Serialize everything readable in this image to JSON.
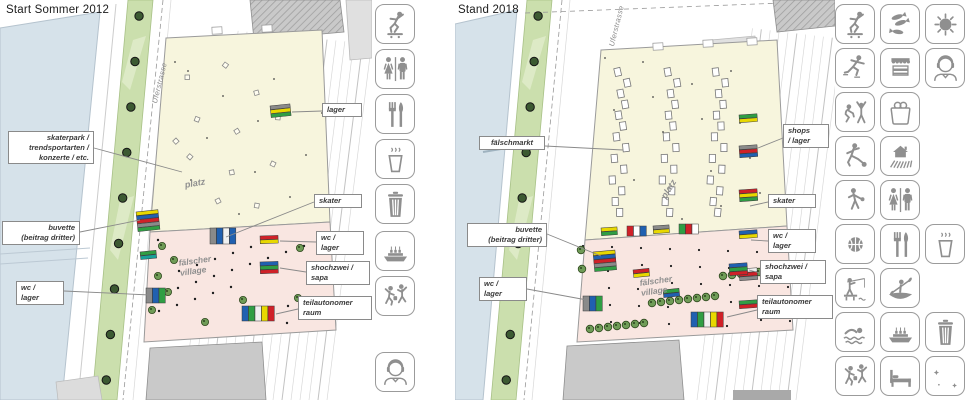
{
  "panel_2012": {
    "title": "Start Sommer 2012",
    "street_name": "Uferstrasse",
    "area_labels": {
      "platz": "platz",
      "village": "fälscher\nvillage"
    },
    "callouts": {
      "skaterpark": "skaterpark /\ntrendsportarten /\nkonzerte / etc.",
      "buvette": "buvette\n(beitrag dritter)",
      "wc_lager_west": "wc /\nlager",
      "lager": "lager",
      "skater": "skater",
      "wc_lager_east": "wc /\nlager",
      "hochzwei_sapa": "shochzwei /\nsapa",
      "teilautonomer_raum": "teilautonomer\nraum"
    },
    "legend_icons": [
      "skateboarding",
      "wc",
      "food",
      "hot-drinks",
      "waste-bin",
      "ship-landing",
      "dancing",
      "dj-music"
    ]
  },
  "panel_2018": {
    "title": "Stand 2018",
    "street_name": "Uferstrasse",
    "area_labels": {
      "platz": "platz",
      "village": "fälscher\nvillage"
    },
    "callouts": {
      "faelschmarkt": "fälschmarkt",
      "buvette": "buvette\n(beitrag dritter)",
      "wc_lager_west": "wc /\nlager",
      "shops_lager": "shops\n/ lager",
      "skater": "skater",
      "wc_lager_east": "wc /\nlager",
      "hochzwei_sapa": "shochzwei /\nsapa",
      "teilautonomer_raum": "teilautonomer\nraum"
    },
    "legend_icons_grid": [
      [
        "skateboarding",
        "fish-market",
        "sun"
      ],
      [
        "ice-skating",
        "market-stall",
        "dj-music"
      ],
      [
        "concert",
        "shopping",
        ""
      ],
      [
        "football",
        "farm",
        ""
      ],
      [
        "boule",
        "wc",
        ""
      ],
      [
        "basketball",
        "food",
        "hot-drinks"
      ],
      [
        "fishing",
        "canoeing",
        ""
      ],
      [
        "swimming",
        "ship-landing",
        "waste-bin"
      ],
      [
        "dancing",
        "sleeping",
        "night"
      ]
    ]
  },
  "colors": {
    "water": "#d6e2ea",
    "green_strip": "#cbdfad",
    "platz_fill": "#f7f5dd",
    "village_fill": "#f9e6e1",
    "icon_grey": "#8f8f8f",
    "container_red": "#cf2128",
    "container_blue": "#2060b0",
    "container_yellow": "#e8d800",
    "container_green": "#2f9e44",
    "container_grey": "#8a8a8a"
  }
}
